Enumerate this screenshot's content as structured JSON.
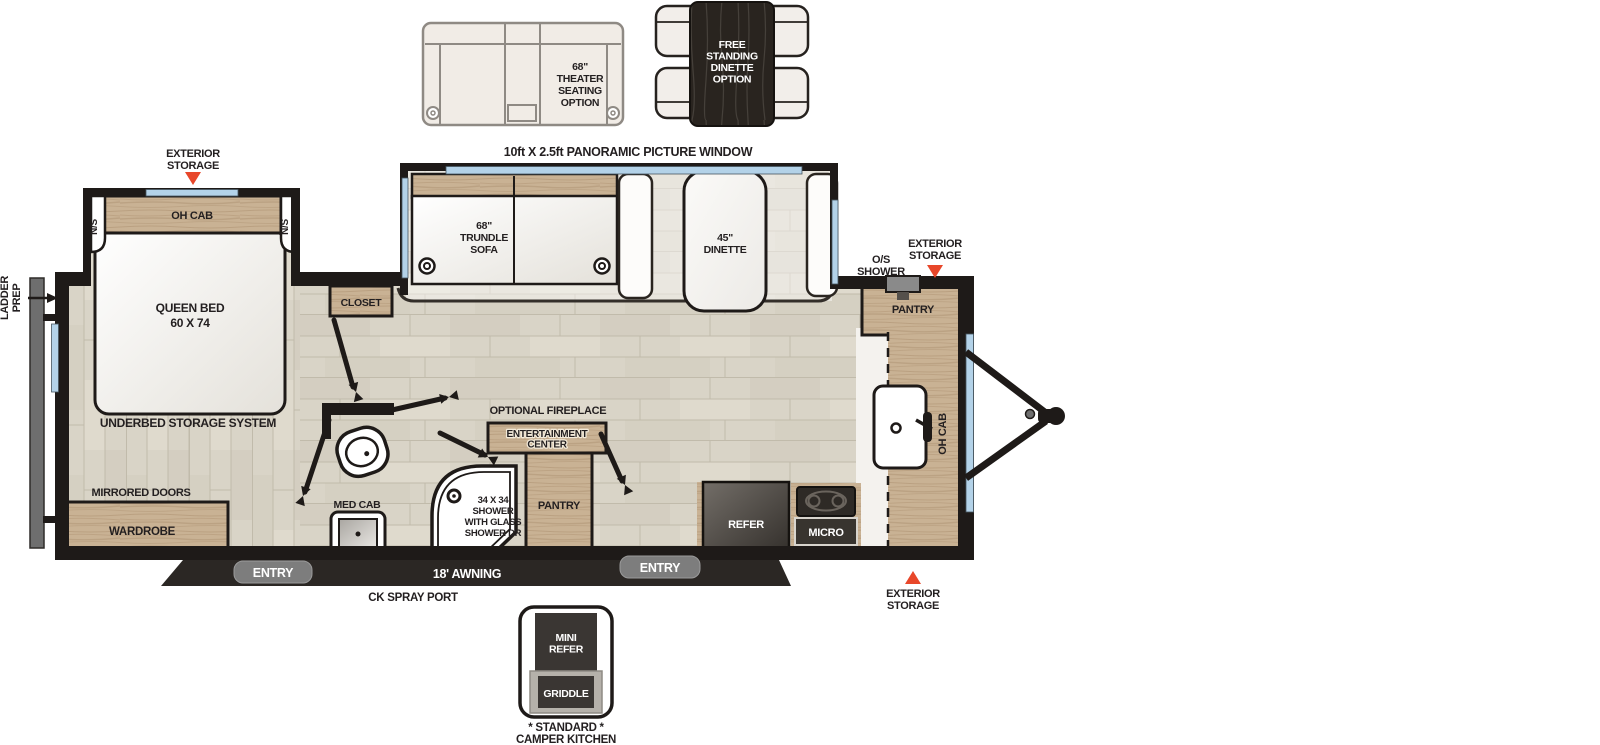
{
  "colors": {
    "wall": "#1e1a18",
    "floor": "#d8d3c6",
    "cabinet_wood": "#c9b294",
    "accent_orange": "#e8472a",
    "window_blue": "#b3d2e8",
    "badge_gray": "#7d7d7d",
    "appliance_dark": "#38342f",
    "awning_bar": "#2b2724"
  },
  "callouts": {
    "panoramic_window": "10ft X 2.5ft PANORAMIC PICTURE WINDOW",
    "exterior_storage_bedroom": "EXTERIOR|STORAGE",
    "exterior_storage_front": "EXTERIOR|STORAGE",
    "exterior_storage_bottom": "EXTERIOR|STORAGE",
    "os_shower": "O/S|SHOWER",
    "ladder_prep": "LADDER|PREP",
    "mirrored_doors": "MIRRORED DOORS",
    "optional_fireplace": "OPTIONAL FIREPLACE",
    "awning": "18' AWNING",
    "ck_spray_port": "CK SPRAY PORT",
    "entry_rear": "ENTRY",
    "entry_front": "ENTRY"
  },
  "optional_items": {
    "theater_seating": "68\"|THEATER|SEATING|OPTION",
    "free_standing_dinette": "FREE|STANDING|DINETTE|OPTION",
    "camper_kitchen": {
      "mini_refer": "MINI|REFER",
      "griddle": "GRIDDLE",
      "caption": "* STANDARD *|CAMPER KITCHEN"
    }
  },
  "rooms": {
    "bedroom": {
      "oh_cab": "OH CAB",
      "ns_left": "N/S",
      "ns_right": "N/S",
      "queen_bed": "QUEEN BED|60 X 74",
      "underbed": "UNDERBED STORAGE SYSTEM",
      "wardrobe": "WARDROBE",
      "closet": "CLOSET"
    },
    "bath": {
      "med_cab": "MED CAB",
      "shower": "34 X 34|SHOWER|WITH GLASS|SHOWER DR"
    },
    "living": {
      "trundle_sofa": "68\"|TRUNDLE|SOFA",
      "dinette": "45\"|DINETTE",
      "entertainment_center": "ENTERTAINMENT|CENTER",
      "pantry": "PANTRY"
    },
    "kitchen": {
      "refer": "REFER",
      "micro": "MICRO",
      "pantry": "PANTRY",
      "oh_cab": "OH CAB"
    }
  }
}
